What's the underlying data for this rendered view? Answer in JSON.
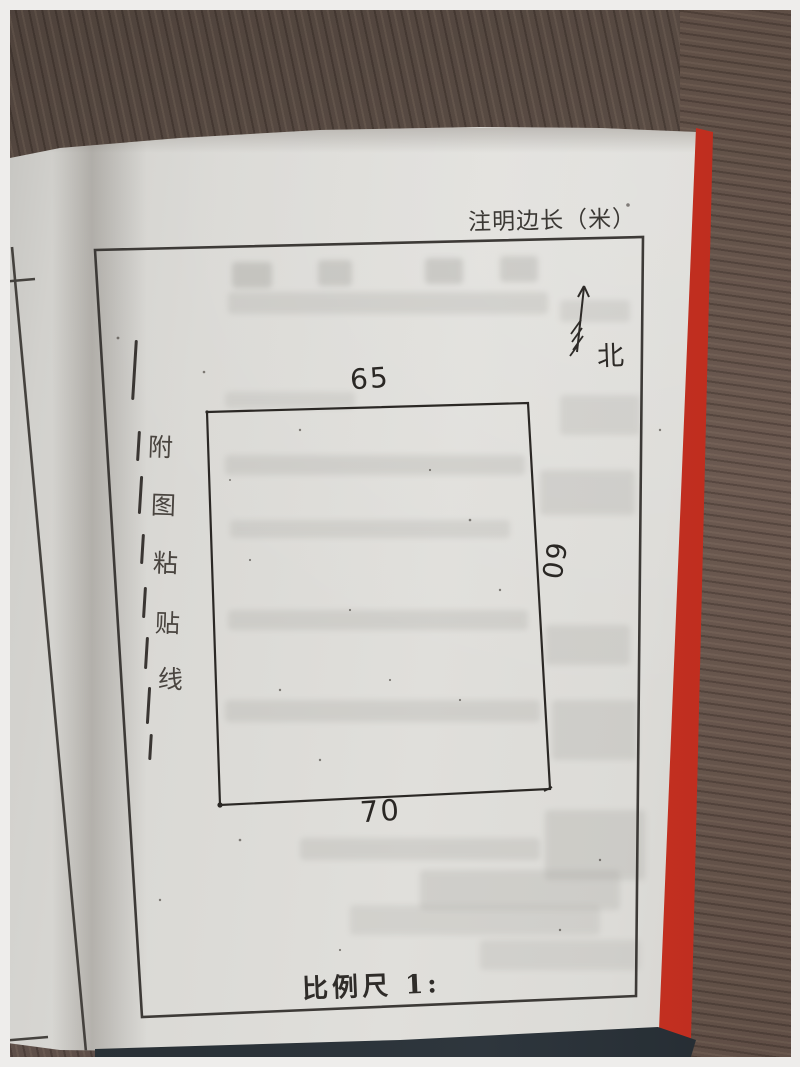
{
  "annotations": {
    "top_note": "注明边长（米）",
    "north_label": "北",
    "scale_label": "比例尺 1:"
  },
  "paste_line": {
    "chars": [
      "附",
      "图",
      "粘",
      "贴",
      "线"
    ]
  },
  "sketch": {
    "side_lengths": {
      "top": "65",
      "right": "60",
      "bottom": "70"
    }
  },
  "colors": {
    "cover_edge_red": "#d63b2a",
    "paper": "#dbdad6",
    "desk_wood": "#5f5148",
    "ink": "#2e2b28"
  }
}
